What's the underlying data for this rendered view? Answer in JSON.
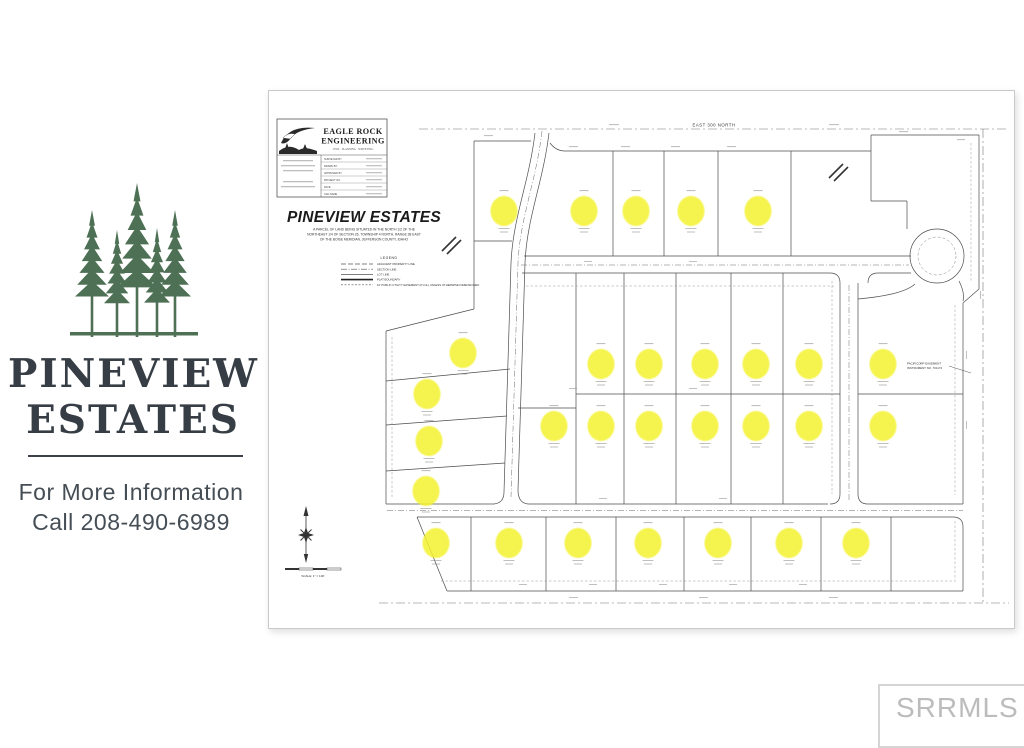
{
  "page": {
    "background": "#ffffff"
  },
  "branding": {
    "logo": "pine-trees-icon",
    "tree_color": "#4e7156",
    "title_line1": "PINEVIEW",
    "title_line2": "ESTATES",
    "title_color": "#363d45",
    "info_line1": "For More Information",
    "info_line2": "Call 208-490-6989",
    "info_color": "#454d55"
  },
  "plat": {
    "firm": {
      "name_line1": "EAGLE ROCK",
      "name_line2": "ENGINEERING",
      "tagline": "CIVIL · PLANNING · SURVEYING",
      "table_labels": [
        "SURVEYED BY",
        "DRAWN BY",
        "APPROVED BY",
        "PROJECT NO.",
        "DATE",
        "CAD NAME"
      ]
    },
    "title": "PINEVIEW ESTATES",
    "description_lines": [
      "A PARCEL OF LAND BEING SITUATED IN THE NORTH 1/2 OF THE",
      "NORTHEAST 1/4 OF SECTION 26, TOWNSHIP 4 NORTH, RANGE 38 EAST",
      "OF THE BOISE MERIDIAN, JEFFERSON COUNTY, IDAHO"
    ],
    "legend": {
      "title": "LEGEND",
      "items": [
        {
          "style": "dash-long",
          "label": "ADJACENT PROPERTY LINE"
        },
        {
          "style": "dash-dot",
          "label": "SECTION LINE"
        },
        {
          "style": "solid-thin",
          "label": "LOT LINE"
        },
        {
          "style": "solid-thick",
          "label": "PLAT BOUNDARY"
        },
        {
          "style": "dashed",
          "label": "10' PUBLIC UTILITY EASEMENT (P.U.E.) UNLESS OTHERWISE DIMENSIONED"
        }
      ]
    },
    "street_label_top": "EAST 300 NORTH",
    "easement_note_line1": "PACIFICORP EASEMENT",
    "easement_note_line2": "INSTRUMENT NO. 701174",
    "scale_label": "SCALE: 1\" = 100'",
    "compass": "north-arrow-icon",
    "lot_marker_color": "#f4f22e",
    "available_lot_markers": [
      [
        235,
        120
      ],
      [
        315,
        120
      ],
      [
        367,
        120
      ],
      [
        422,
        120
      ],
      [
        489,
        120
      ],
      [
        194,
        262
      ],
      [
        158,
        303
      ],
      [
        160,
        350
      ],
      [
        157,
        400
      ],
      [
        332,
        273
      ],
      [
        380,
        273
      ],
      [
        436,
        273
      ],
      [
        487,
        273
      ],
      [
        540,
        273
      ],
      [
        614,
        273
      ],
      [
        285,
        335
      ],
      [
        332,
        335
      ],
      [
        380,
        335
      ],
      [
        436,
        335
      ],
      [
        487,
        335
      ],
      [
        540,
        335
      ],
      [
        614,
        335
      ],
      [
        167,
        452
      ],
      [
        240,
        452
      ],
      [
        309,
        452
      ],
      [
        379,
        452
      ],
      [
        449,
        452
      ],
      [
        520,
        452
      ],
      [
        587,
        452
      ]
    ]
  },
  "watermark": {
    "label": "SRRMLS"
  }
}
